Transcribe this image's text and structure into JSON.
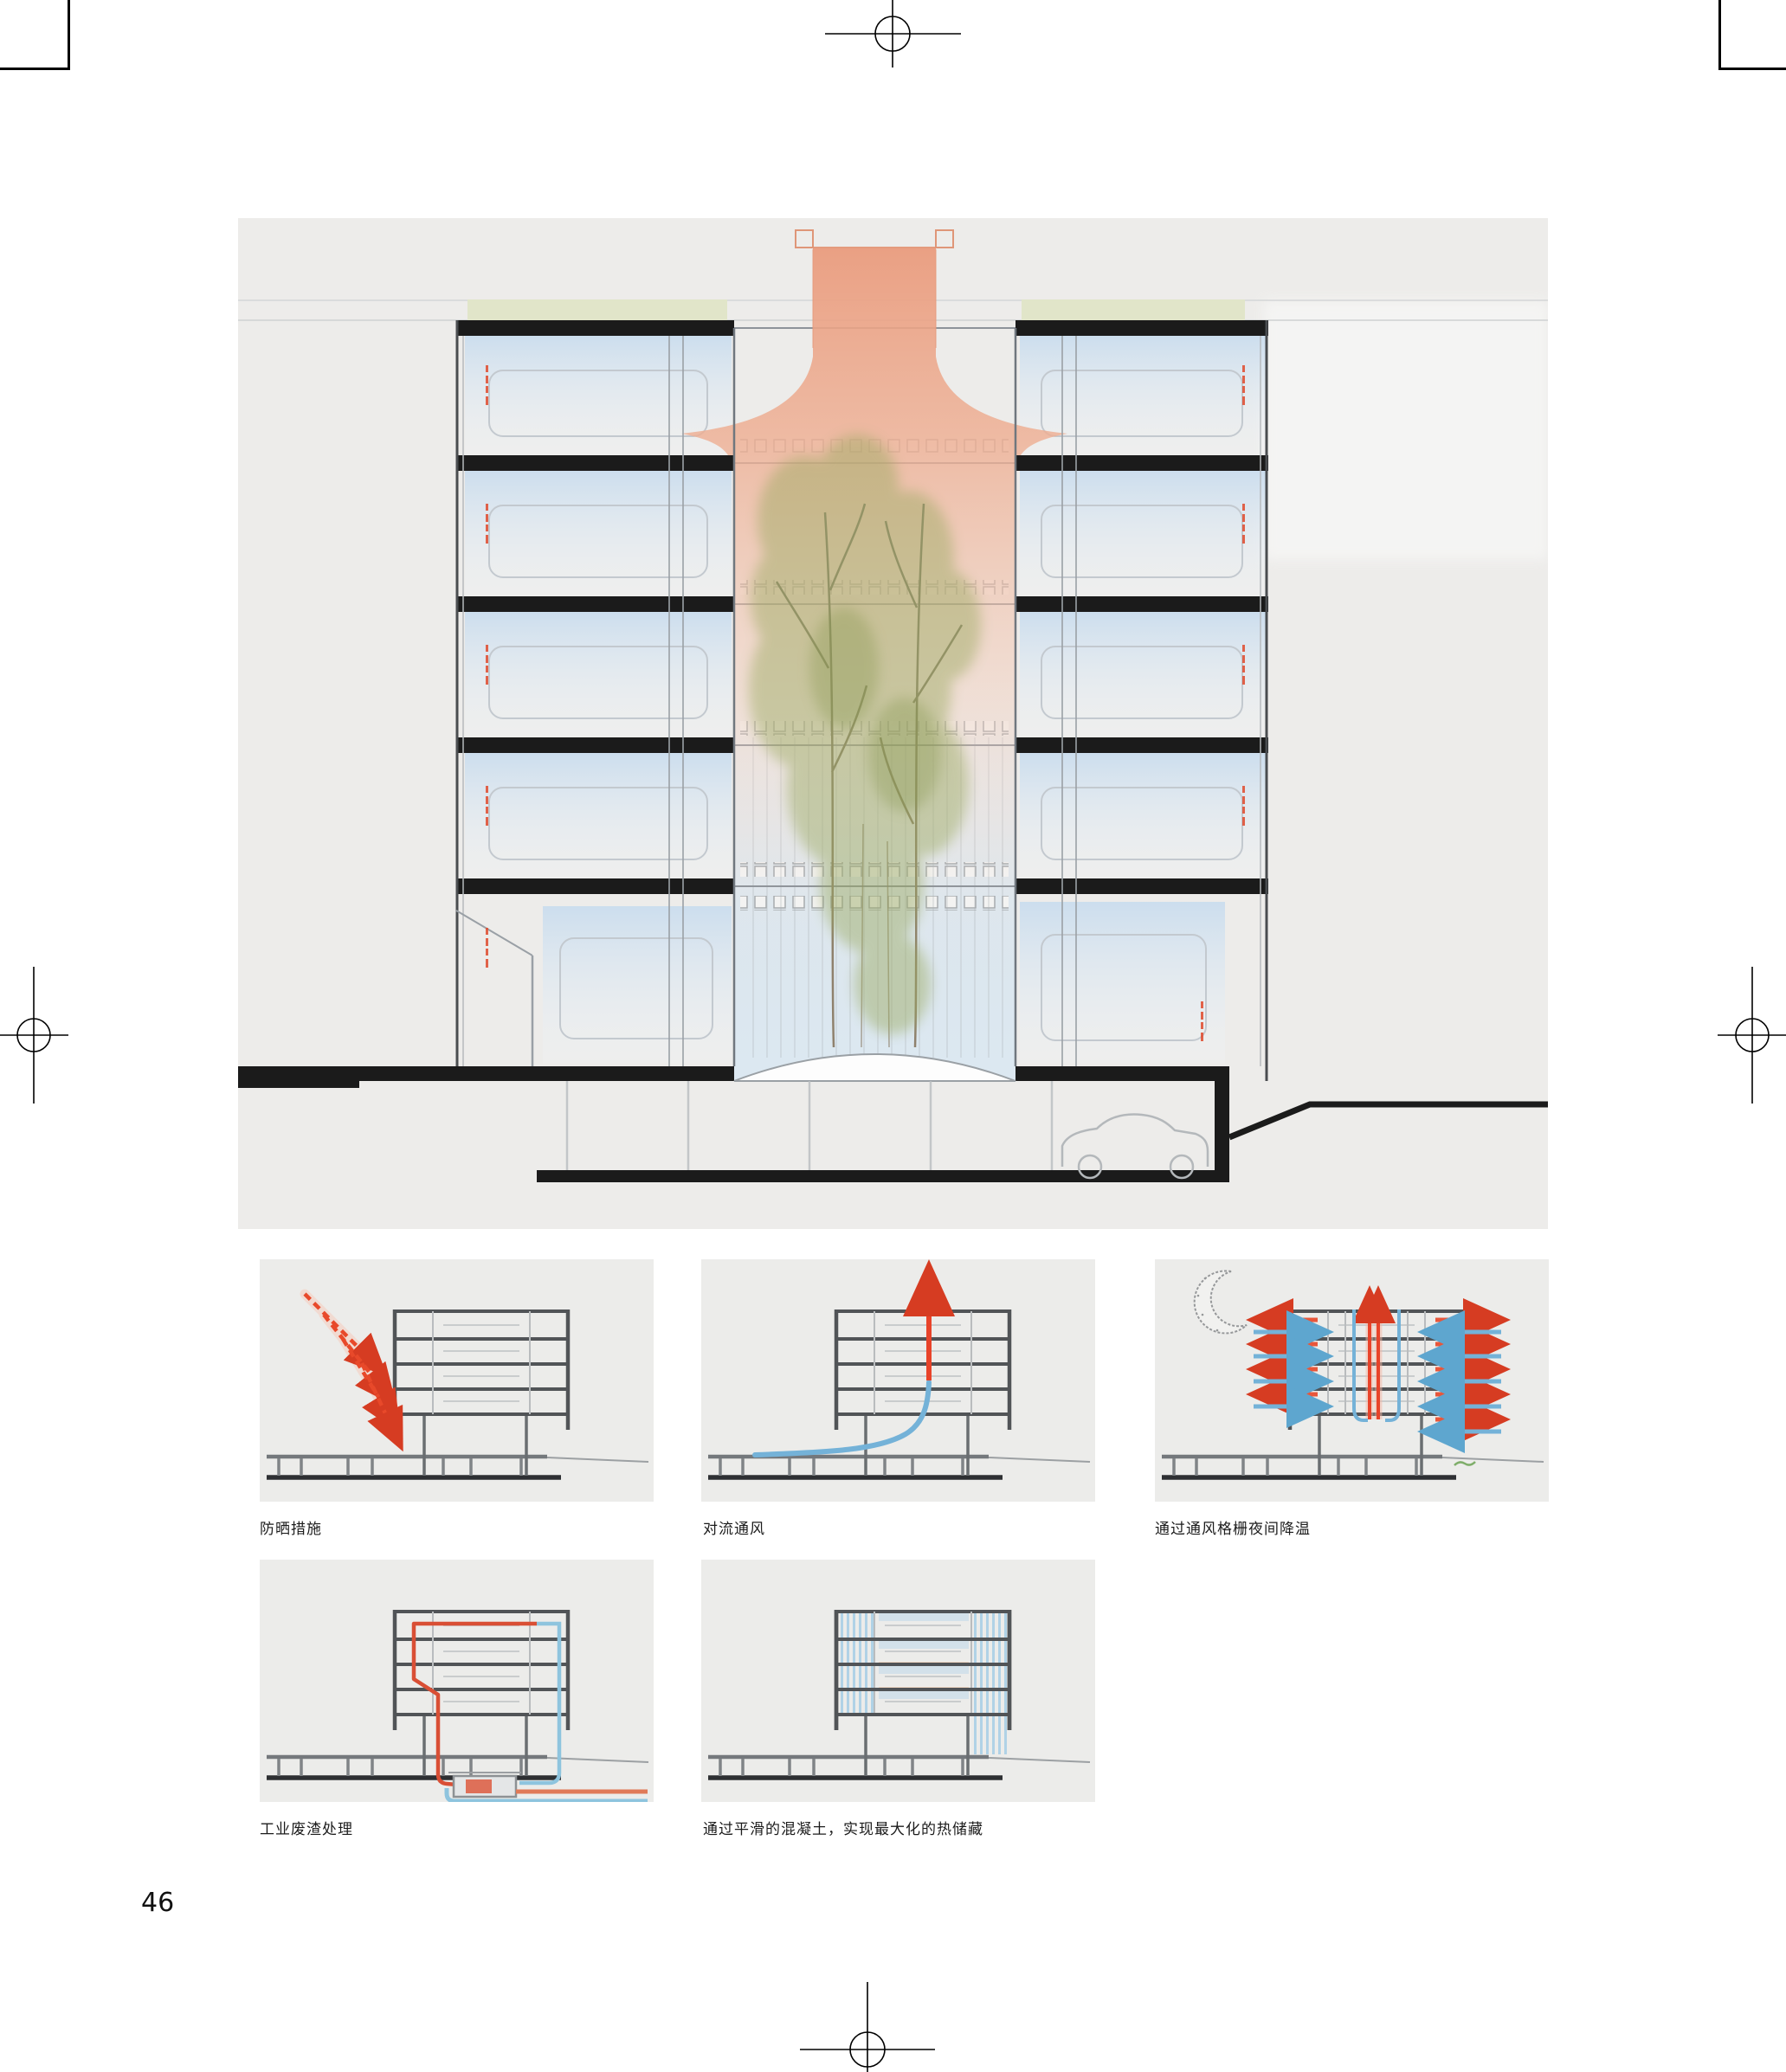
{
  "page": {
    "number": "46"
  },
  "diagrams": [
    {
      "name": "sun-protection",
      "caption": "防晒措施"
    },
    {
      "name": "convective-ventilation",
      "caption": "对流通风"
    },
    {
      "name": "night-cooling",
      "caption": "通过通风格栅夜间降温"
    },
    {
      "name": "industrial-waste-heat",
      "caption": "工业废渣处理"
    },
    {
      "name": "thermal-storage",
      "caption": "通过平滑的混凝土，实现最大化的热储藏"
    }
  ],
  "colors": {
    "panel_gray": "#edecea",
    "accent_red": "#e04a2d",
    "flow_blue": "#74b2d8",
    "atrium_orange": "#eda184",
    "roof_green": "#e1e5c9",
    "foliage_green": "#9aa95f",
    "slab_black": "#1b1b1b"
  }
}
